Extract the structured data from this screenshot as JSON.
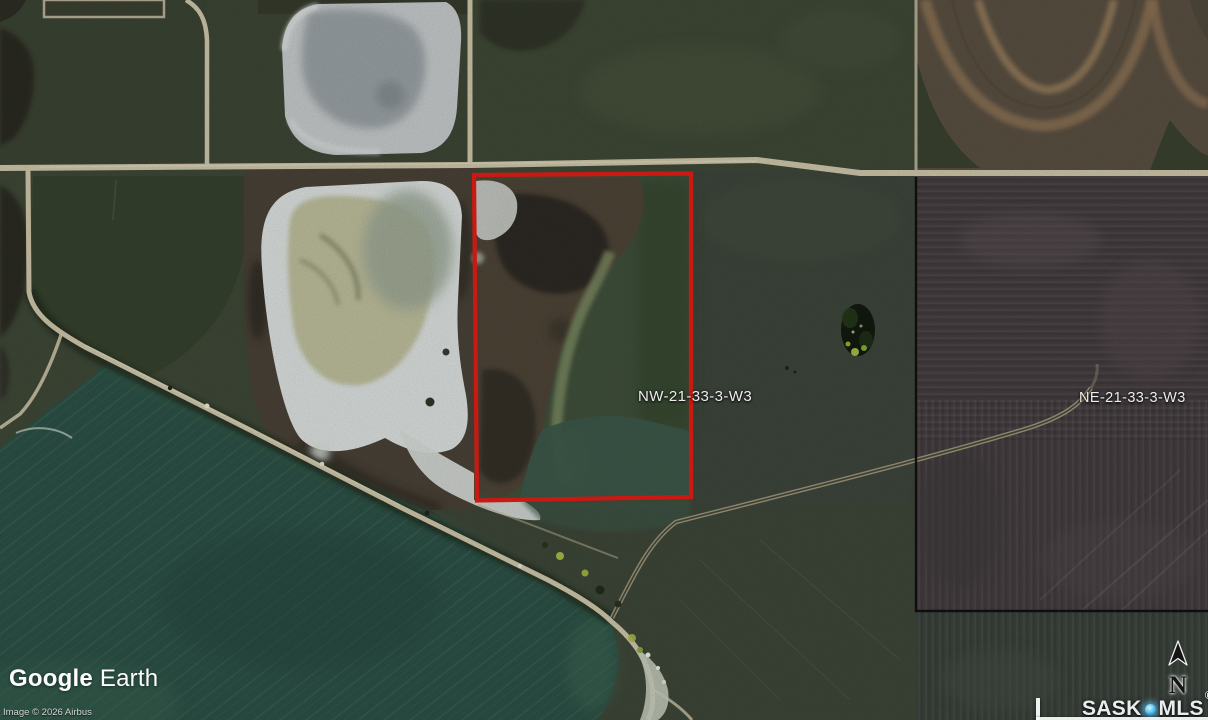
{
  "map": {
    "parcel_labels": [
      {
        "quarter": "NW",
        "text": "NW-21-33-3-W3"
      },
      {
        "quarter": "NE",
        "text": "NE-21-33-3-W3"
      }
    ],
    "colors": {
      "parcel_outline": "#e41d15",
      "section_boundary": "#0d0d0d",
      "road": "#cfc7ab",
      "lake_water": "#2c5146",
      "pond_salt": "#dde2e0",
      "pin_accent": "#4db9e9"
    }
  },
  "branding": {
    "google_earth": {
      "word1": "Google",
      "word2": "Earth"
    },
    "copyright": "Image © 2026 Airbus",
    "watermark": {
      "sask": "SASK",
      "mls": "MLS",
      "registered": "®"
    }
  },
  "compass": {
    "north_label": "N"
  }
}
